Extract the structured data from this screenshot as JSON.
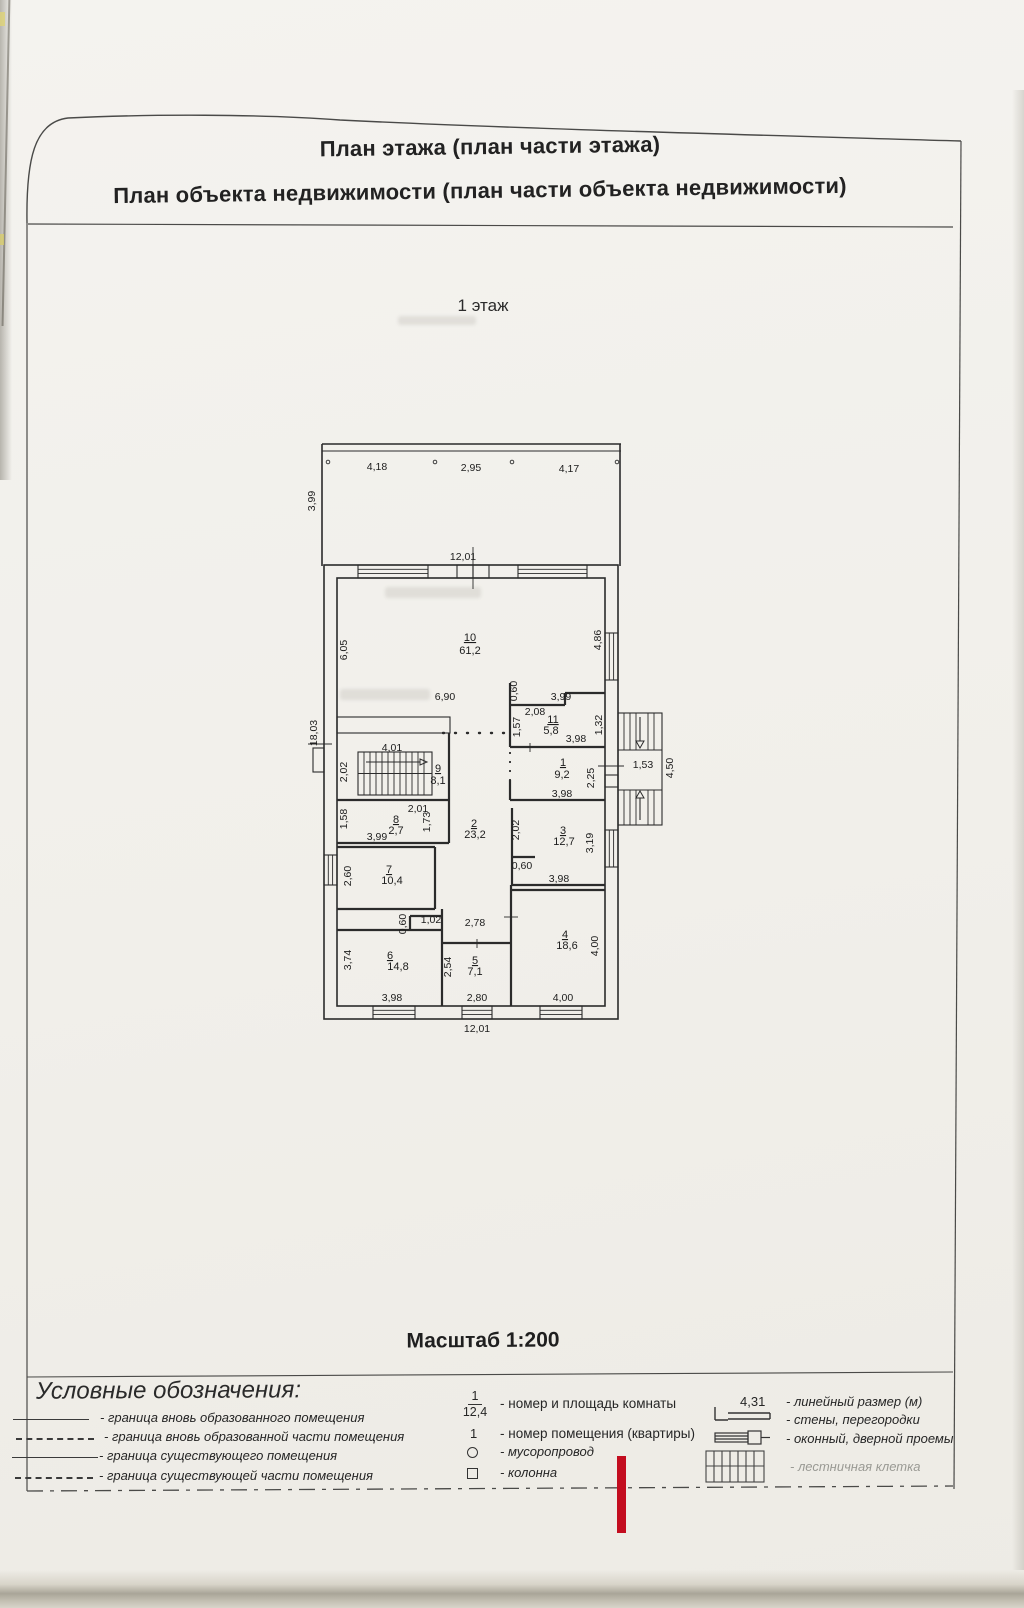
{
  "header": {
    "line1": "План этажа (план части этажа)",
    "line2": "План объекта недвижимости (план части объекта недвижимости)"
  },
  "floor_label": "1 этаж",
  "scale_label": "Масштаб 1:200",
  "plan": {
    "rooms": [
      {
        "number": "10",
        "area": "61,2"
      },
      {
        "number": "11",
        "area": "5,8"
      },
      {
        "number": "1",
        "area": "9,2"
      },
      {
        "number": "9",
        "area": "8,1"
      },
      {
        "number": "8",
        "area": "2,7"
      },
      {
        "number": "2",
        "area": "23,2"
      },
      {
        "number": "3",
        "area": "12,7"
      },
      {
        "number": "7",
        "area": "10,4"
      },
      {
        "number": "6",
        "area": "14,8"
      },
      {
        "number": "5",
        "area": "7,1"
      },
      {
        "number": "4",
        "area": "18,6"
      }
    ],
    "dims": {
      "terrace_w1": "4,18",
      "terrace_w2": "2,95",
      "terrace_w3": "4,17",
      "terrace_d": "3,99",
      "width_top": "12,01",
      "width_bottom": "12,01",
      "height_left": "18,03",
      "r10_left": "6,05",
      "r10_right": "4,86",
      "r10_mid": "6,90",
      "r11_off": "0,60",
      "r11_top": "3,99",
      "r11_w": "2,08",
      "r11_left": "1,57",
      "r11_right": "1,32",
      "r11_bottom": "3,98",
      "r1_right": "2,25",
      "r1_bottom": "3,98",
      "r9_top": "4,01",
      "r9_left": "2,02",
      "r8_top": "2,01",
      "r8_left": "1,58",
      "r8_right": "1,73",
      "r8_bottom": "3,99",
      "r2_bottom": "2,78",
      "r3_left": "2,02",
      "r3_right": "3,19",
      "r3_niche": "0,60",
      "r3_bottom": "3,98",
      "r7_left": "2,60",
      "hall_h": "0,60",
      "hall_w": "1,02",
      "r6_left": "3,74",
      "r6_bottom": "3,98",
      "r5_left": "2,54",
      "r5_bottom": "2,80",
      "r4_right": "4,00",
      "r4_bottom": "4,00",
      "stairs_w": "1,53",
      "stairs_d": "4,50"
    }
  },
  "legend": {
    "title": "Условные обозначения:",
    "boundary_items": [
      {
        "label": "- граница вновь образованного помещения"
      },
      {
        "label": "- граница вновь образованной части помещения"
      },
      {
        "label": "- граница существующего помещения"
      },
      {
        "label": "- граница существующей части помещения"
      }
    ],
    "symbol_items": [
      {
        "num": "1",
        "den": "12,4",
        "label": "- номер и площадь комнаты"
      },
      {
        "mark": "1",
        "label": "- номер помещения (квартиры)"
      },
      {
        "label": "- мусоропровод"
      },
      {
        "label": "- колонна"
      }
    ],
    "right_items": [
      {
        "mark": "4,31",
        "label": "- линейный размер (м)"
      },
      {
        "label": "- стены, перегородки"
      },
      {
        "label": "- оконный, дверной проемы"
      },
      {
        "label": "- лестничная клетка"
      }
    ]
  }
}
